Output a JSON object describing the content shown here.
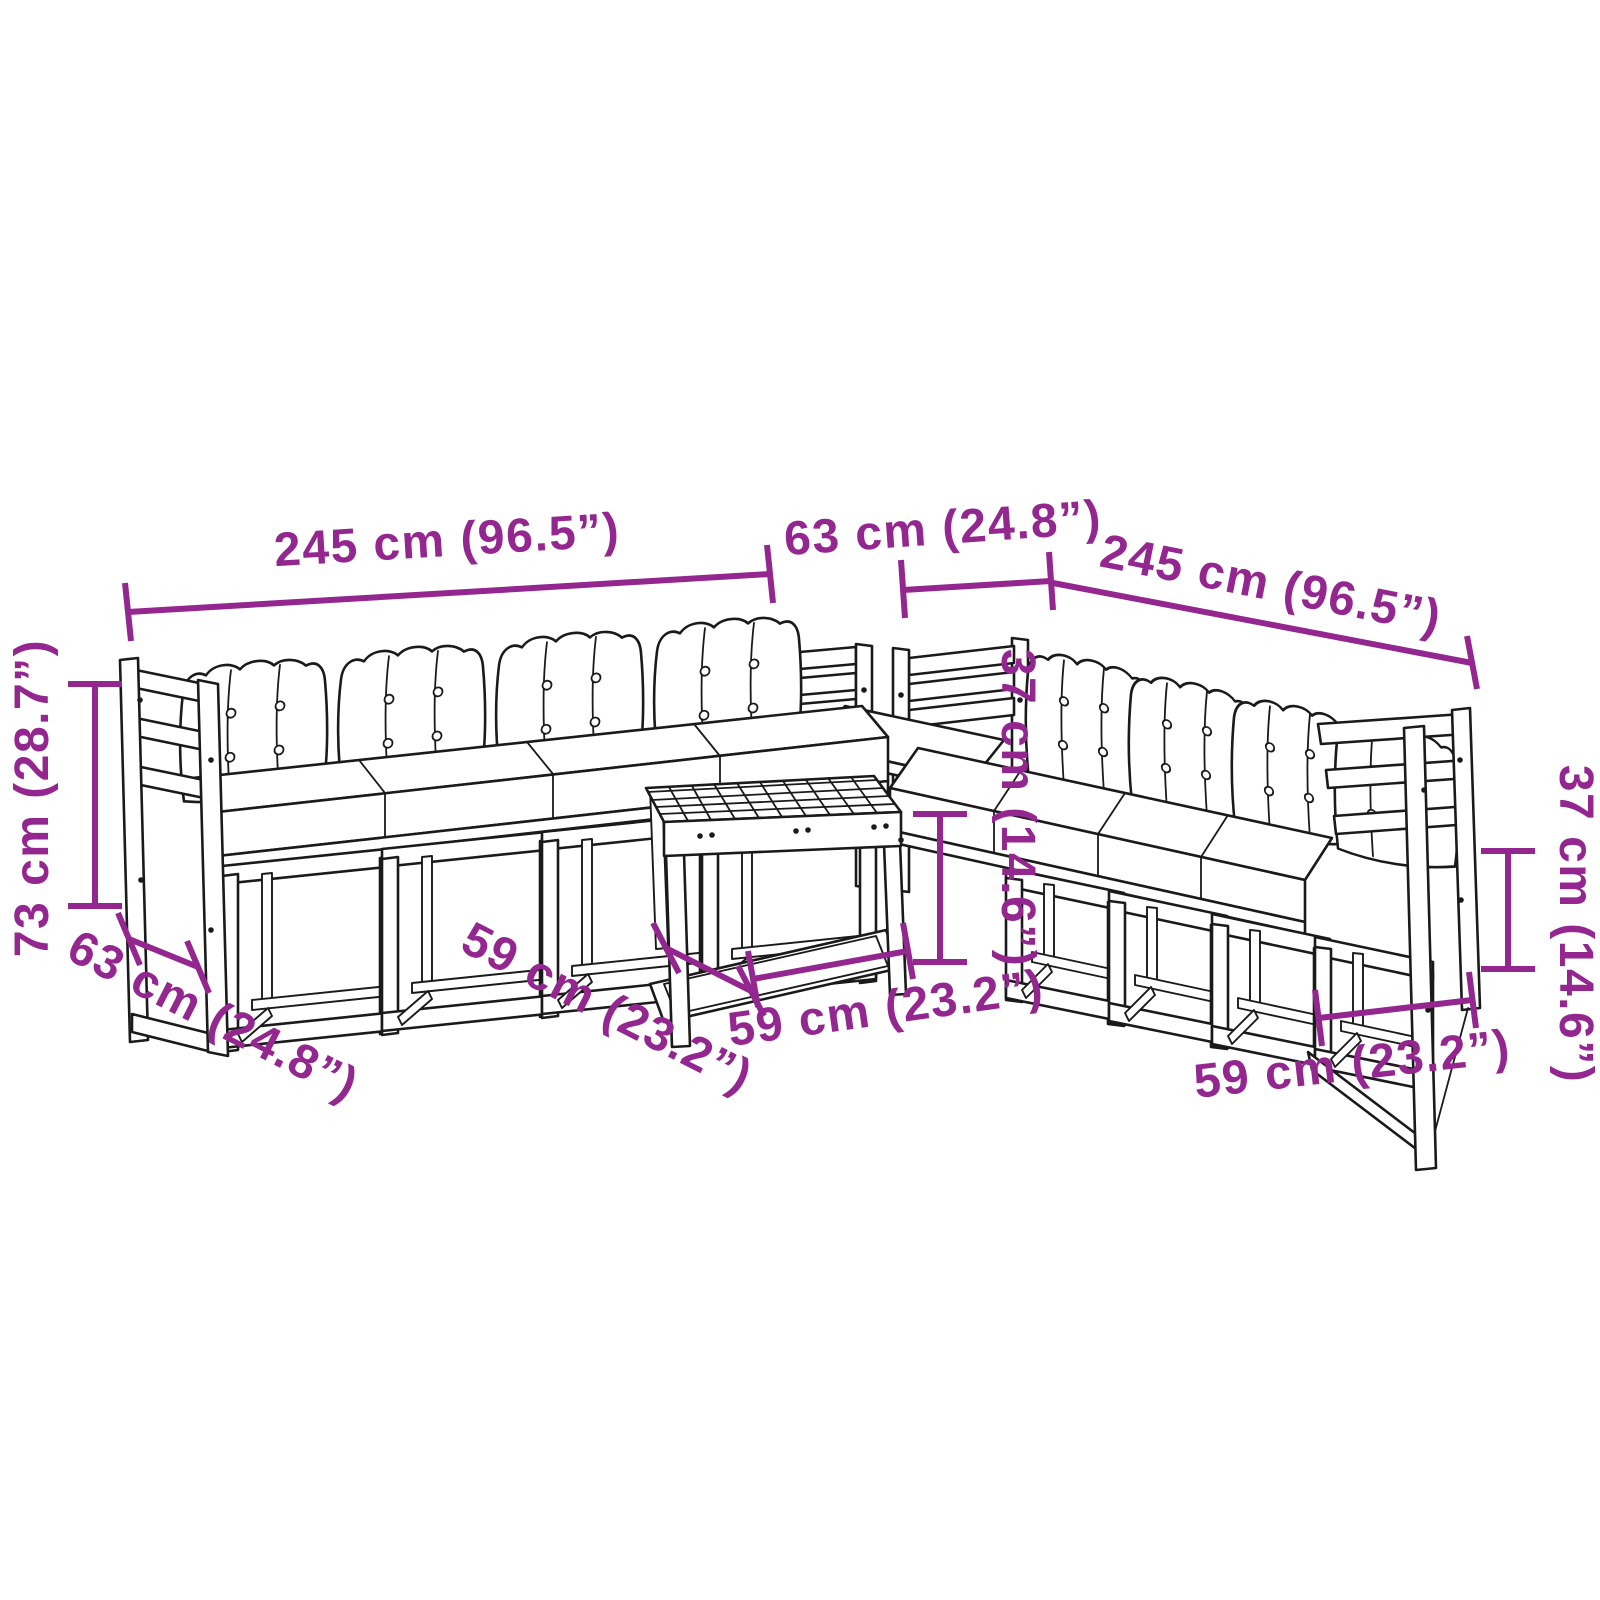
{
  "canvas": {
    "width": 1600,
    "height": 1600,
    "background": "#ffffff"
  },
  "diagram": {
    "kind": "product dimension line drawing",
    "subject": "garden lounge set: two modular slatted sofas with cushions, corner module and slatted coffee table",
    "accent_color": "#93278F",
    "outline_color": "#1a1a1a",
    "labels": {
      "sofa_left_width": "245 cm (96.5”)",
      "corner_width": "63 cm (24.8”)",
      "sofa_right_width": "245 cm (96.5”)",
      "overall_height": "73 cm (28.7”)",
      "sofa_depth": "63 cm (24.8”)",
      "table_depth": "59 cm (23.2”)",
      "table_width": "59 cm (23.2”)",
      "table_height": "37 cm (14.6”)",
      "backrest_height": "37 cm (14.6”)",
      "module_width": "59 cm (23.2”)"
    }
  }
}
